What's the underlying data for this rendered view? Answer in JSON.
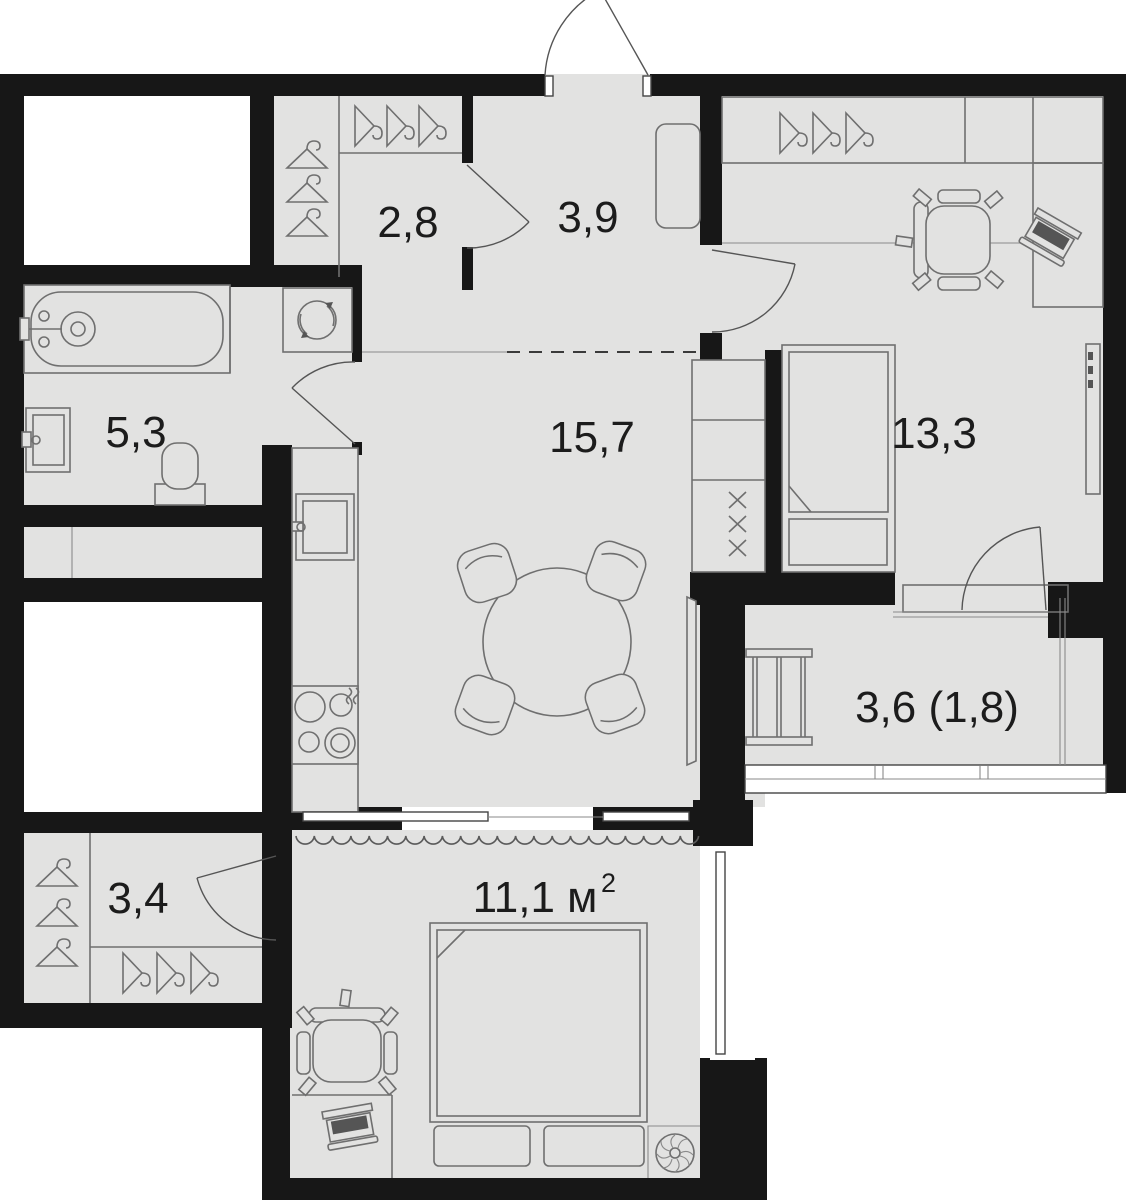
{
  "floor_plan": {
    "type": "apartment-floor-plan",
    "colors": {
      "wall": "#171717",
      "floor": "#e2e2e1",
      "background": "#ffffff",
      "furniture_line": "#6f6f6f"
    },
    "rooms": {
      "dressing": {
        "label": "2,8"
      },
      "hallway": {
        "label": "3,9"
      },
      "bathroom": {
        "label": "5,3"
      },
      "kitchen_living": {
        "label": "15,7"
      },
      "bedroom_main": {
        "label": "13,3"
      },
      "loggia": {
        "label": "3,6 (1,8)"
      },
      "wardrobe": {
        "label": "3,4"
      },
      "bedroom_second": {
        "label": "11,1 м²",
        "label_base": "11,1 м",
        "label_sup": "2"
      }
    },
    "fixtures": [
      "entrance-door",
      "interior-door",
      "sliding-door",
      "curtain",
      "zone-dash-line",
      "bathtub",
      "washing-machine",
      "bathroom-sink",
      "toilet",
      "kitchen-counter",
      "kitchen-sink",
      "hob",
      "tall-cabinet-column",
      "dining-table",
      "dining-chair",
      "tv",
      "wardrobe-hangers",
      "shoe-hangers",
      "hall-cabinet",
      "double-bed",
      "single-bed",
      "office-chair",
      "desk",
      "laptop",
      "radiator",
      "drying-rack",
      "loggia-glazing",
      "window",
      "ventilation-fan"
    ]
  }
}
